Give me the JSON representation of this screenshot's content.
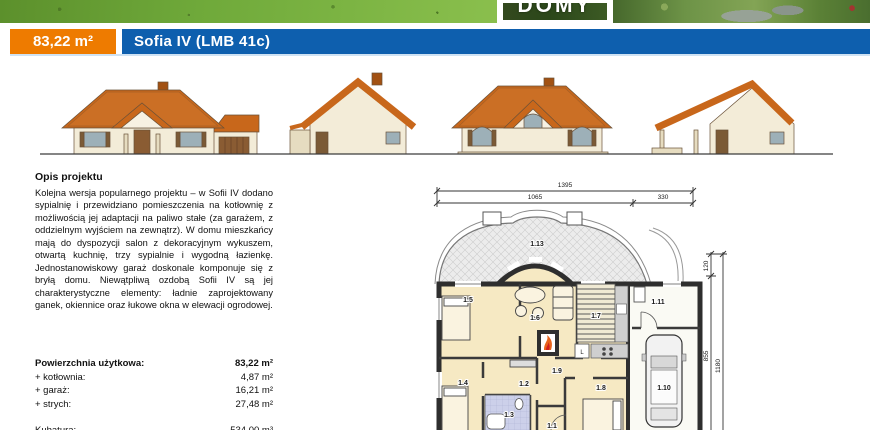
{
  "header": {
    "logo_text": "DOMY",
    "area_badge": "83,22 m²",
    "title": "Sofia IV (LMB 41c)",
    "accent_orange": "#ee7b00",
    "accent_blue": "#0e5fae"
  },
  "description": {
    "heading": "Opis projektu",
    "body": "Kolejna wersja popularnego projektu – w Sofii IV dodano sypialnię i przewidziano pomieszczenia na kotłownię z możliwością jej adaptacji na paliwo stałe (za garażem, z oddzielnym wyjściem na zewnątrz). W domu mieszkańcy mają do dyspozycji salon z dekoracyjnym wykuszem, otwartą kuchnię, trzy sypialnie i wygodną łazienkę. Jednostanowiskowy garaż doskonale komponuje się z bryłą domu. Niewątpliwą ozdobą Sofii IV są jej charakterystyczne elementy: ładnie zaprojektowany ganek, okiennice oraz łukowe okna w elewacji ogrodowej."
  },
  "areas": {
    "rows": [
      {
        "label": "Powierzchnia użytkowa:",
        "value": "83,22 m²"
      },
      {
        "label": "+ kotłownia:",
        "value": "4,87 m²"
      },
      {
        "label": "+ garaż:",
        "value": "16,21 m²"
      },
      {
        "label": "+ strych:",
        "value": "27,48 m²"
      }
    ],
    "volume_label": "Kubatura:",
    "volume_value": "534,00 m³"
  },
  "plan": {
    "dims": {
      "total": "1395",
      "seg_left": "1065",
      "seg_right": "330",
      "v_top": "120",
      "v_mid": "855",
      "v_total": "1180"
    },
    "rooms": {
      "r1": "1.1",
      "r2": "1.2",
      "r3": "1.3",
      "r4": "1.4",
      "r5": "1.5",
      "r6": "1.6",
      "r7": "1.7",
      "r8": "1.8",
      "r9": "1.9",
      "r10": "1.10",
      "r11": "1.11",
      "r13": "1.13"
    },
    "fridge": "L"
  }
}
